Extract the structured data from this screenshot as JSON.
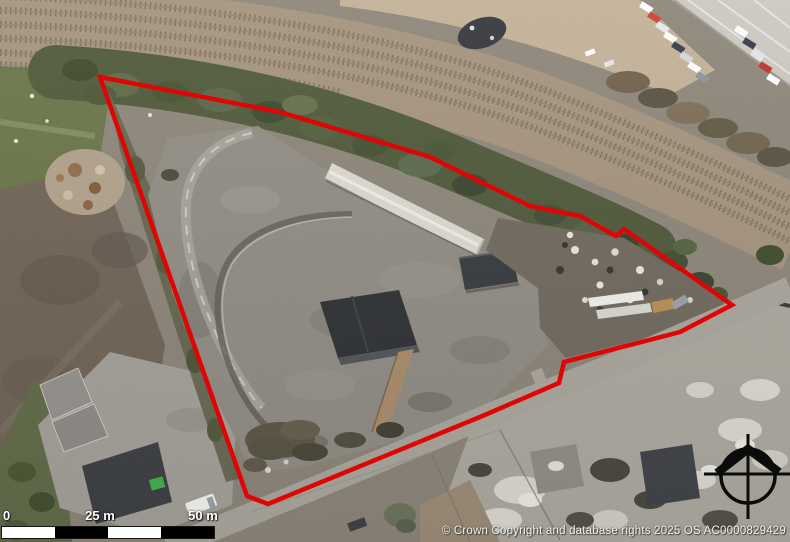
{
  "map": {
    "title": "Aerial site location plan with red edged boundary",
    "copyright": "© Crown Copyright and database rights 2025 OS AC0000829429"
  },
  "boundary": {
    "color": "#e00505",
    "stroke_width": 4.5,
    "points_str": "100,77 280,112 430,157 530,206 580,216 616,236 624,229 732,305 680,332 564,362 559,383 480,417 268,504 247,496",
    "points": [
      [
        100,
        77
      ],
      [
        280,
        112
      ],
      [
        430,
        157
      ],
      [
        530,
        206
      ],
      [
        580,
        216
      ],
      [
        616,
        236
      ],
      [
        624,
        229
      ],
      [
        732,
        305
      ],
      [
        680,
        332
      ],
      [
        564,
        362
      ],
      [
        559,
        383
      ],
      [
        480,
        417
      ],
      [
        268,
        504
      ],
      [
        247,
        496
      ]
    ]
  },
  "scale_bar": {
    "labels": [
      "0",
      "25 m",
      "50 m"
    ],
    "segments": [
      "#ffffff",
      "#000000",
      "#ffffff",
      "#000000"
    ],
    "border_color": "#161616"
  },
  "compass": {
    "color": "#0b0b0b",
    "direction": "north"
  },
  "palette": {
    "earth": "#8b8376",
    "yard_concrete": "#8f8b82",
    "trees": "#4b5534",
    "railway_ballast": "#a3917b",
    "road": "#a9a59b",
    "warehouse_roof": "#dcdad0",
    "dark_roof": "#2b2d31",
    "rubble": "#aca89d"
  }
}
